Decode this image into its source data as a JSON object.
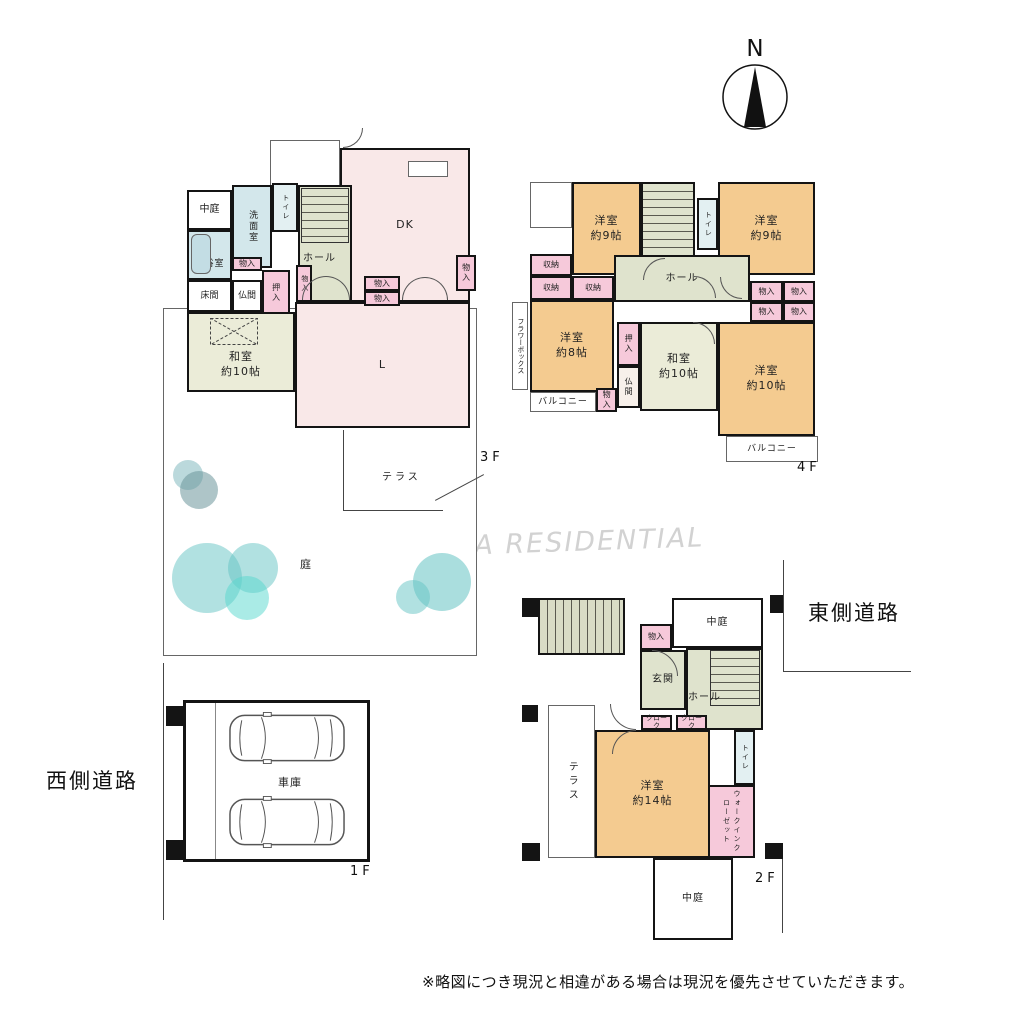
{
  "page": {
    "compass": "N",
    "watermark": "FUTABA RESIDENTIAL",
    "disclaimer": "※略図につき現況と相違がある場合は現況を優先させていただきます。",
    "road_east": "東側道路",
    "road_west": "西側道路",
    "colors": {
      "wall": "#141414",
      "western_room": "#f4cb90",
      "japanese_room": "#ebecd8",
      "hall": "#dfe3cd",
      "bath": "#d3e7eb",
      "storage_pink": "#f6c9da",
      "ldk_pink": "#f9e8e8",
      "tree_teal": "#6fc5c4"
    }
  },
  "shared": {
    "monoiri": "物入",
    "oshiire": "押入",
    "shuno": "収納",
    "butsuma": "仏間",
    "hall": "ホール",
    "toilet": "トイレ",
    "balcony": "バルコニー",
    "nakaniwa": "中庭",
    "cloak": "クローク",
    "terrace": "テラス"
  },
  "floors": {
    "f3": {
      "tag": "3F",
      "dk": "DK",
      "living": "L",
      "washitsu": {
        "name": "和室",
        "size": "約10帖"
      },
      "senmen": "洗面室",
      "bath": "浴室",
      "tokonoma": "床間",
      "garden": "庭"
    },
    "f4": {
      "tag": "4F",
      "bed9l": {
        "name": "洋室",
        "size": "約9帖"
      },
      "bed9r": {
        "name": "洋室",
        "size": "約9帖"
      },
      "bed8": {
        "name": "洋室",
        "size": "約8帖"
      },
      "bed10": {
        "name": "洋室",
        "size": "約10帖"
      },
      "washitsu": {
        "name": "和室",
        "size": "約10帖"
      },
      "flower_box": "フラワーボックス"
    },
    "f2": {
      "tag": "2F",
      "bed14": {
        "name": "洋室",
        "size": "約14帖"
      },
      "genkan": "玄関",
      "wic": "ウォークインクローゼット"
    },
    "f1": {
      "tag": "1F",
      "garage": "車庫"
    }
  }
}
